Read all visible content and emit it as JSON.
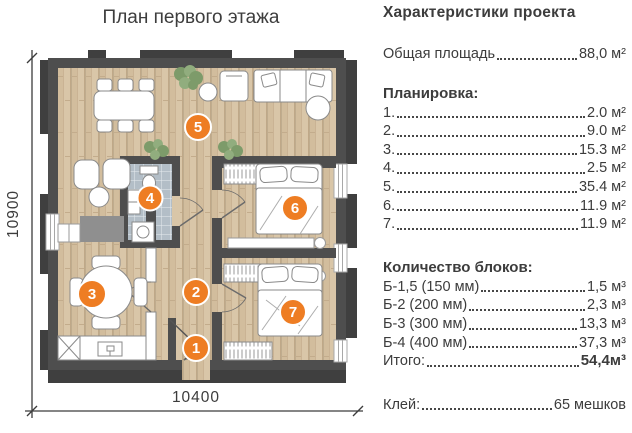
{
  "plan": {
    "title": "План первого этажа",
    "dimensions": {
      "height_label": "10900",
      "width_label": "10400"
    },
    "rooms": [
      "1",
      "2",
      "3",
      "4",
      "5",
      "6",
      "7"
    ]
  },
  "specs": {
    "title": "Характеристики проекта",
    "total_area": {
      "label": "Общая площадь",
      "value": "88,0 м²"
    },
    "layout_section": {
      "title": "Планировка:",
      "items": [
        {
          "label": "1.",
          "value": "2.0 м²"
        },
        {
          "label": "2.",
          "value": "9.0 м²"
        },
        {
          "label": "3.",
          "value": "15.3 м²"
        },
        {
          "label": "4.",
          "value": "2.5 м²"
        },
        {
          "label": "5.",
          "value": "35.4 м²"
        },
        {
          "label": "6.",
          "value": "11.9 м²"
        },
        {
          "label": "7.",
          "value": "11.9 м²"
        }
      ]
    },
    "blocks_section": {
      "title": "Количество блоков:",
      "items": [
        {
          "label": "Б-1,5 (150 мм)",
          "value": "1,5 м³"
        },
        {
          "label": "Б-2 (200 мм)",
          "value": "2,3 м³"
        },
        {
          "label": "Б-3 (300 мм)",
          "value": "13,3 м³"
        },
        {
          "label": "Б-4 (400 мм)",
          "value": "37,3 м³"
        }
      ],
      "total": {
        "label": "Итого:",
        "value": "54,4м³"
      }
    },
    "glue": {
      "label": "Клей:",
      "value": "65 мешков"
    }
  },
  "colors": {
    "accent_orange": "#ee7d23",
    "wall_gray": "#4e4e4e",
    "floor_wood": "#d9c6a8",
    "tile_gray": "#b3bec7",
    "text": "#3c3c3c"
  }
}
